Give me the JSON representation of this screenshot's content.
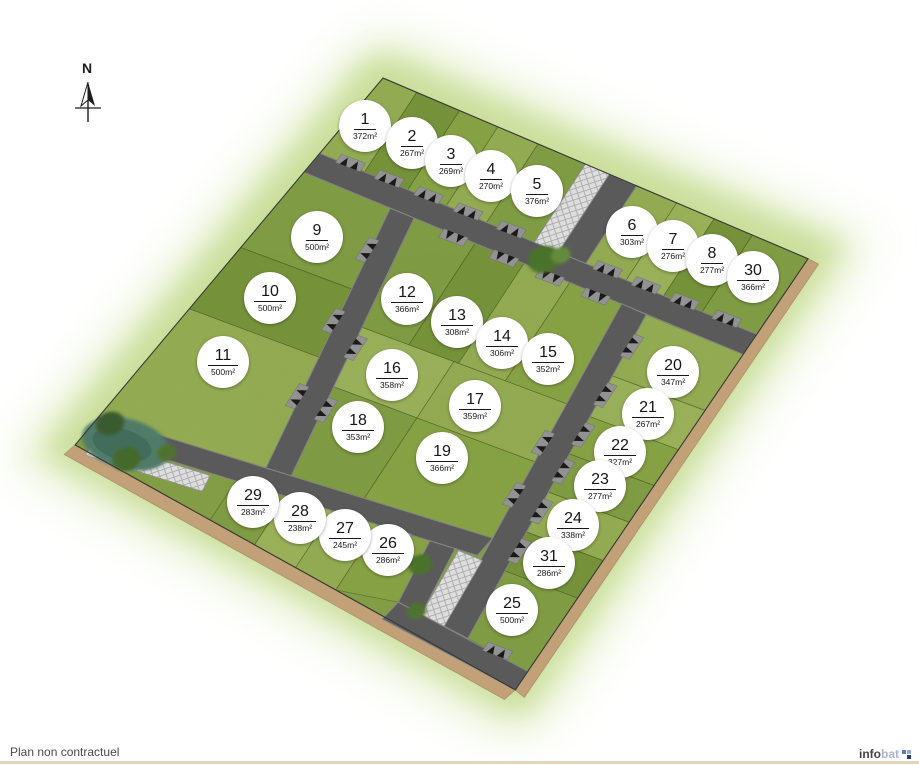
{
  "compass": {
    "label": "N"
  },
  "footer": {
    "disclaimer": "Plan non contractuel",
    "logo": {
      "text_primary": "info",
      "text_secondary": "bat"
    }
  },
  "site": {
    "title": "Plan de lotissement",
    "area_unit": "m²",
    "colors": {
      "road": "#606060",
      "grass_base": "#8ba74b",
      "halo": "#cfe3a2",
      "path_brown": "#c2a178",
      "pond": "#57836f",
      "badge_bg": "#ffffff",
      "badge_text": "#161616"
    },
    "lots": [
      {
        "number": "1",
        "area": "372",
        "x": 365,
        "y": 126
      },
      {
        "number": "2",
        "area": "267",
        "x": 412,
        "y": 143
      },
      {
        "number": "3",
        "area": "269",
        "x": 451,
        "y": 161
      },
      {
        "number": "4",
        "area": "270",
        "x": 491,
        "y": 176
      },
      {
        "number": "5",
        "area": "376",
        "x": 537,
        "y": 191
      },
      {
        "number": "6",
        "area": "303",
        "x": 632,
        "y": 232
      },
      {
        "number": "7",
        "area": "276",
        "x": 673,
        "y": 246
      },
      {
        "number": "8",
        "area": "277",
        "x": 712,
        "y": 260
      },
      {
        "number": "9",
        "area": "500",
        "x": 317,
        "y": 237
      },
      {
        "number": "10",
        "area": "500",
        "x": 270,
        "y": 298
      },
      {
        "number": "11",
        "area": "500",
        "x": 223,
        "y": 362
      },
      {
        "number": "12",
        "area": "366",
        "x": 407,
        "y": 299
      },
      {
        "number": "13",
        "area": "308",
        "x": 457,
        "y": 322
      },
      {
        "number": "14",
        "area": "306",
        "x": 502,
        "y": 343
      },
      {
        "number": "15",
        "area": "352",
        "x": 548,
        "y": 359
      },
      {
        "number": "16",
        "area": "358",
        "x": 392,
        "y": 375
      },
      {
        "number": "17",
        "area": "359",
        "x": 475,
        "y": 406
      },
      {
        "number": "18",
        "area": "353",
        "x": 358,
        "y": 427
      },
      {
        "number": "19",
        "area": "366",
        "x": 442,
        "y": 458
      },
      {
        "number": "20",
        "area": "347",
        "x": 673,
        "y": 372
      },
      {
        "number": "21",
        "area": "267",
        "x": 648,
        "y": 414
      },
      {
        "number": "22",
        "area": "327",
        "x": 620,
        "y": 452
      },
      {
        "number": "23",
        "area": "277",
        "x": 600,
        "y": 486
      },
      {
        "number": "24",
        "area": "338",
        "x": 573,
        "y": 525
      },
      {
        "number": "25",
        "area": "500",
        "x": 512,
        "y": 610
      },
      {
        "number": "26",
        "area": "286",
        "x": 388,
        "y": 550
      },
      {
        "number": "27",
        "area": "245",
        "x": 345,
        "y": 535
      },
      {
        "number": "28",
        "area": "238",
        "x": 300,
        "y": 518
      },
      {
        "number": "29",
        "area": "283",
        "x": 253,
        "y": 502
      },
      {
        "number": "30",
        "area": "366",
        "x": 753,
        "y": 277
      },
      {
        "number": "31",
        "area": "286",
        "x": 549,
        "y": 563
      }
    ]
  }
}
